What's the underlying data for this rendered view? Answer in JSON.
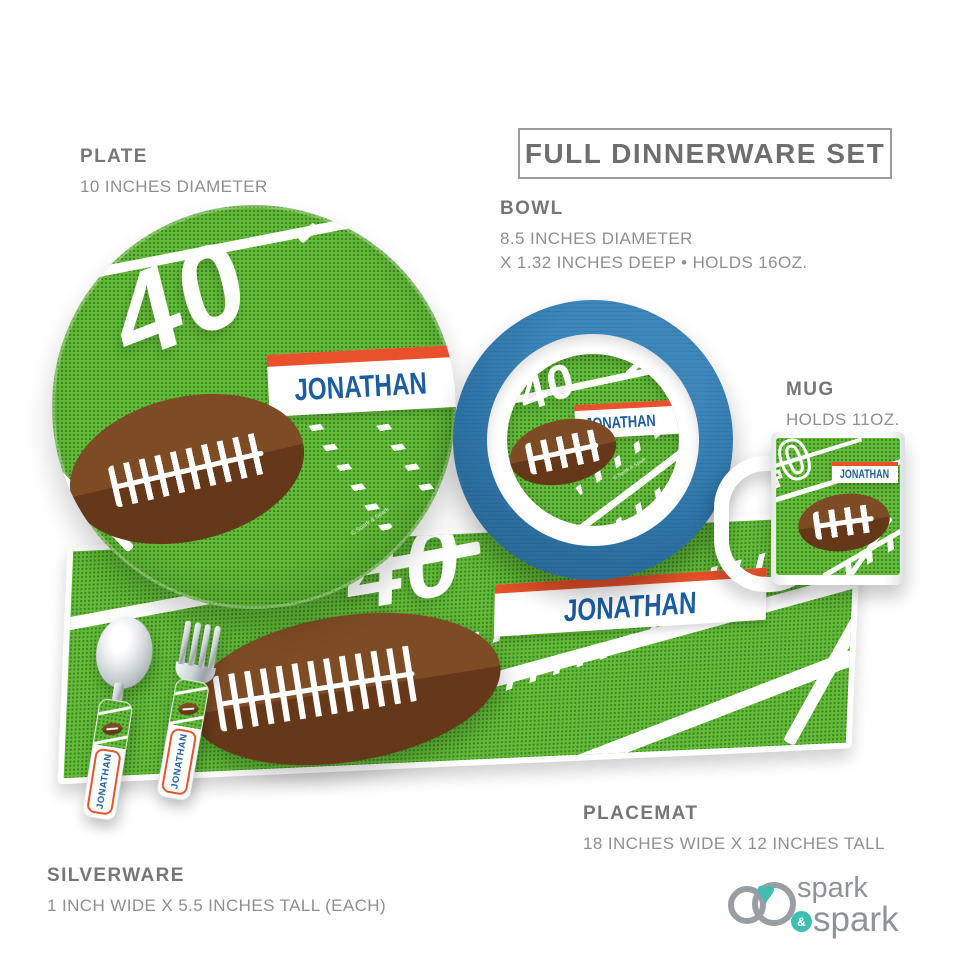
{
  "title": "FULL DINNERWARE SET",
  "personalization": {
    "name": "JONATHAN",
    "field_number": "40"
  },
  "products": {
    "plate": {
      "label": "PLATE",
      "specs": [
        "10 INCHES DIAMETER"
      ]
    },
    "bowl": {
      "label": "BOWL",
      "specs": [
        "8.5 INCHES DIAMETER",
        "X 1.32 INCHES DEEP • HOLDS 16OZ."
      ]
    },
    "mug": {
      "label": "MUG",
      "specs": [
        "HOLDS 11OZ."
      ]
    },
    "placemat": {
      "label": "PLACEMAT",
      "specs": [
        "18 INCHES WIDE X 12 INCHES TALL"
      ]
    },
    "silverware": {
      "label": "SILVERWARE",
      "specs": [
        "1 INCH WIDE X 5.5 INCHES TALL (EACH)"
      ]
    }
  },
  "brand": {
    "word_top": "spark",
    "ampersand": "&",
    "word_bottom": "spark"
  },
  "watermark": "© Spark & Spark",
  "colors": {
    "field_green": "#64ba3a",
    "field_dot_green": "#2f7d16",
    "band_orange": "#e8512b",
    "name_blue": "#1c5d9f",
    "bowl_blue": "#2e74a6",
    "football_brown": "#7d4c25",
    "football_brown_dark": "#66381a",
    "label_gray": "#8f8f8f",
    "logo_teal": "#41bdb1",
    "logo_gray": "#8f9296"
  }
}
